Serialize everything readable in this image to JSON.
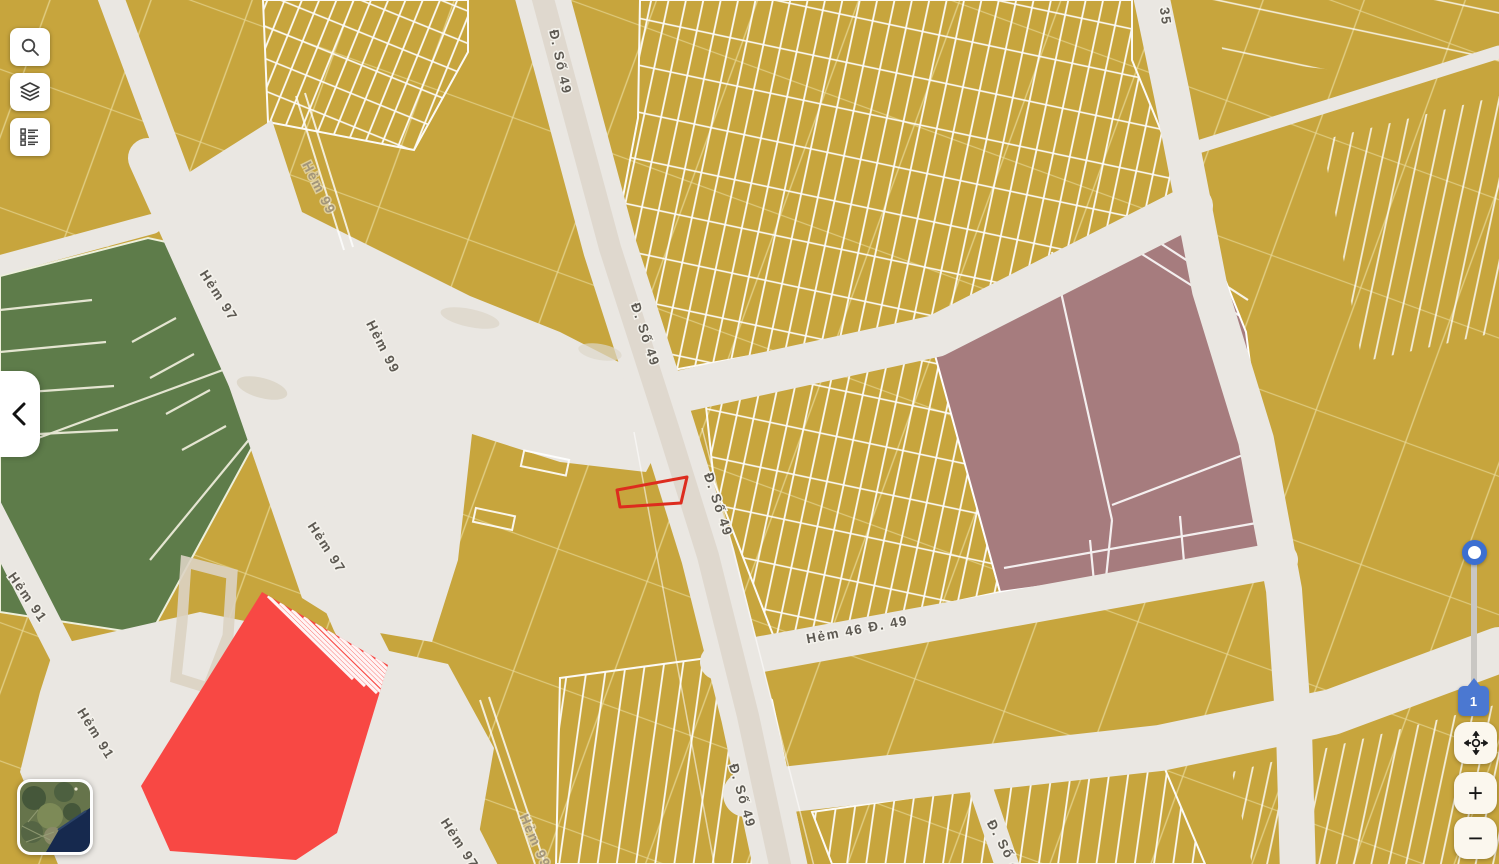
{
  "map": {
    "labels": [
      {
        "text": "Đ. Số 49"
      },
      {
        "text": "Đ. Số 49"
      },
      {
        "text": "Đ. Số 49"
      },
      {
        "text": "Đ. Số 49"
      },
      {
        "text": "Đ. Số 49"
      },
      {
        "text": "35"
      },
      {
        "text": "Hẻm 46 Đ. 49"
      },
      {
        "text": "Hẻm 97"
      },
      {
        "text": "Hẻm 97"
      },
      {
        "text": "Hẻm 97"
      },
      {
        "text": "Hẻm 99"
      },
      {
        "text": "Hẻm 99"
      },
      {
        "text": "Hẻm 99"
      },
      {
        "text": "Hẻm 91"
      },
      {
        "text": "Hẻm 91"
      }
    ],
    "zone_colors": {
      "parcel_yellow": "#c7a53d",
      "green_zone": "#5e7c4a",
      "planned_zone_mauve": "#a67c7e",
      "alert_zone_red": "#f84844",
      "street_gray": "#eae7e2",
      "selected_parcel_outline": "#dd2c1e"
    }
  },
  "toolbar": {
    "buttons": [
      {
        "icon": "search-icon"
      },
      {
        "icon": "layers-icon"
      },
      {
        "icon": "legend-list-icon"
      }
    ]
  },
  "panel": {
    "collapse_icon": "chevron-left-icon"
  },
  "minimap": {
    "type": "satellite-preview"
  },
  "zoom_controls": {
    "marker_badge": "1",
    "pan_icon": "pan-crosshair-icon",
    "zoom_in": "+",
    "zoom_out": "−"
  }
}
